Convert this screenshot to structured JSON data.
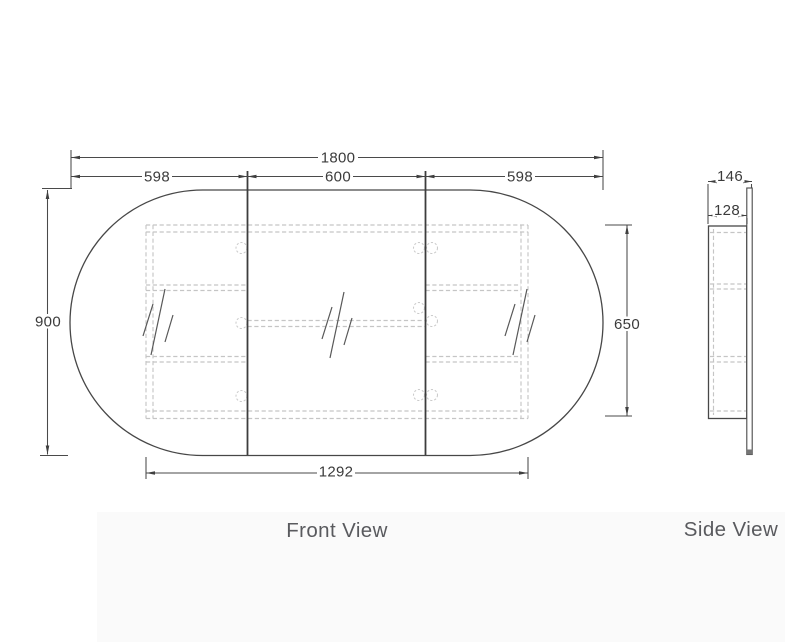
{
  "drawing": {
    "front_view": {
      "label": "Front View",
      "dims": {
        "overall_width": "1800",
        "left_door_width": "598",
        "center_door_width": "600",
        "right_door_width": "598",
        "overall_height": "900",
        "cabinet_height": "650",
        "cabinet_width": "1292"
      }
    },
    "side_view": {
      "label": "Side View",
      "dims": {
        "overall_depth": "146",
        "cabinet_depth": "128"
      }
    },
    "colors": {
      "outline_ink": "#474747",
      "hidden_line": "#c5c5c5",
      "dimension_text": "#3b3b3b",
      "view_label_text": "#595a5e",
      "background": "#ffffff"
    }
  }
}
